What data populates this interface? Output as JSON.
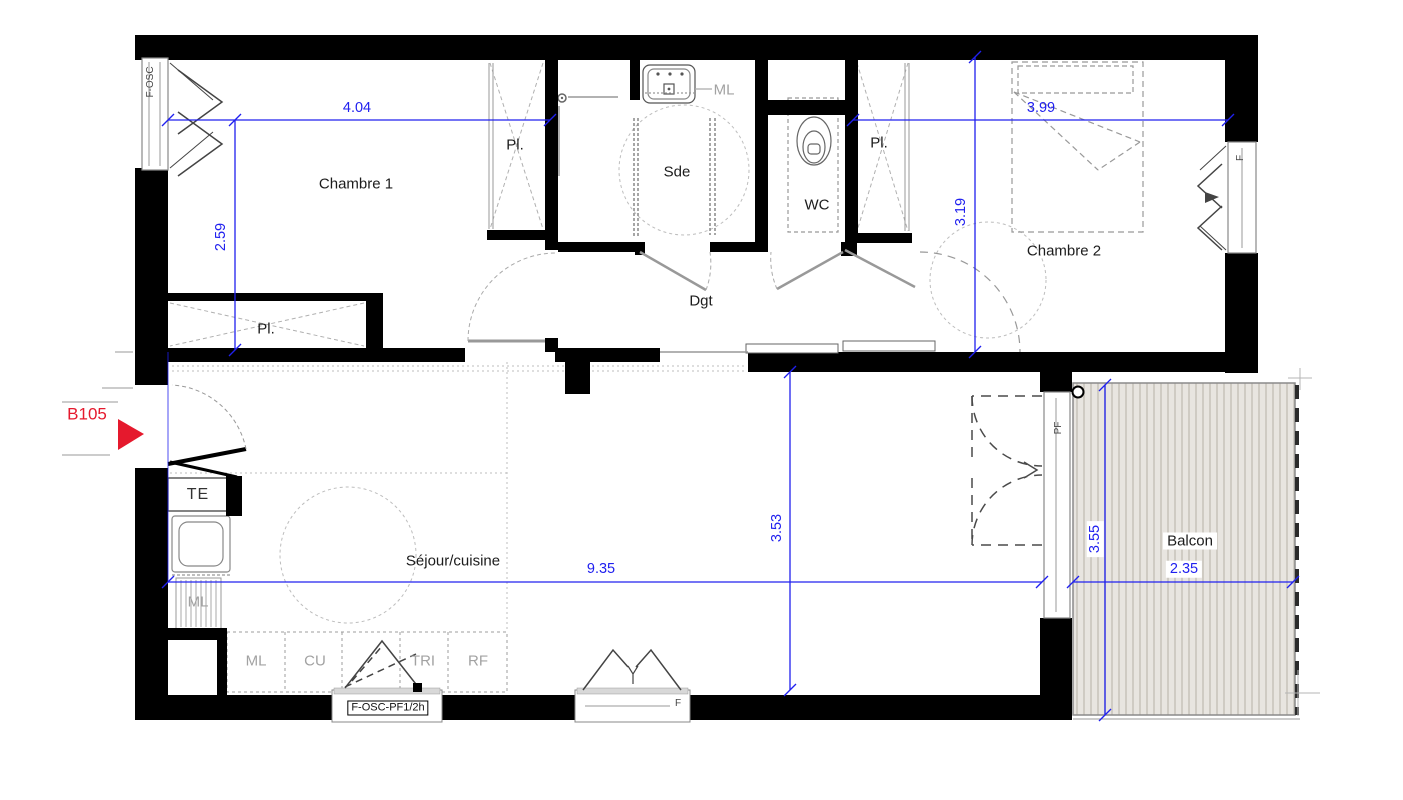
{
  "unit_label": "B105",
  "rooms": {
    "chambre1": "Chambre 1",
    "chambre2": "Chambre 2",
    "sde": "Sde",
    "wc": "WC",
    "dgt": "Dgt",
    "sejour": "Séjour/cuisine",
    "balcon": "Balcon"
  },
  "closets": {
    "pl_chambre1": "Pl.",
    "pl_hall": "Pl.",
    "pl_chambre2": "Pl."
  },
  "fixtures": {
    "te": "TE",
    "ml_sde": "ML",
    "ml_kitchen": "ML"
  },
  "kitchen_counter": [
    "ML",
    "CU",
    "TRI",
    "RF"
  ],
  "windows": {
    "entry_window": "F-OSC",
    "kitchen_window": "F-OSC-PF1/2h",
    "sejour_window": "F",
    "chambre2_window": "F",
    "balcony_door": "PF"
  },
  "dimensions": {
    "chambre1_width": "4.04",
    "chambre1_depth": "2.59",
    "chambre2_width": "3.99",
    "chambre2_depth": "3.19",
    "sejour_width": "9.35",
    "sejour_depth": "3.53",
    "balcon_depth": "3.55",
    "balcon_width": "2.35"
  },
  "colors": {
    "dimension": "#2020ef",
    "unit": "#e5192d",
    "wall": "#000000",
    "deck": "#e8e5e0",
    "deck_stripe": "#c9c5bc"
  }
}
